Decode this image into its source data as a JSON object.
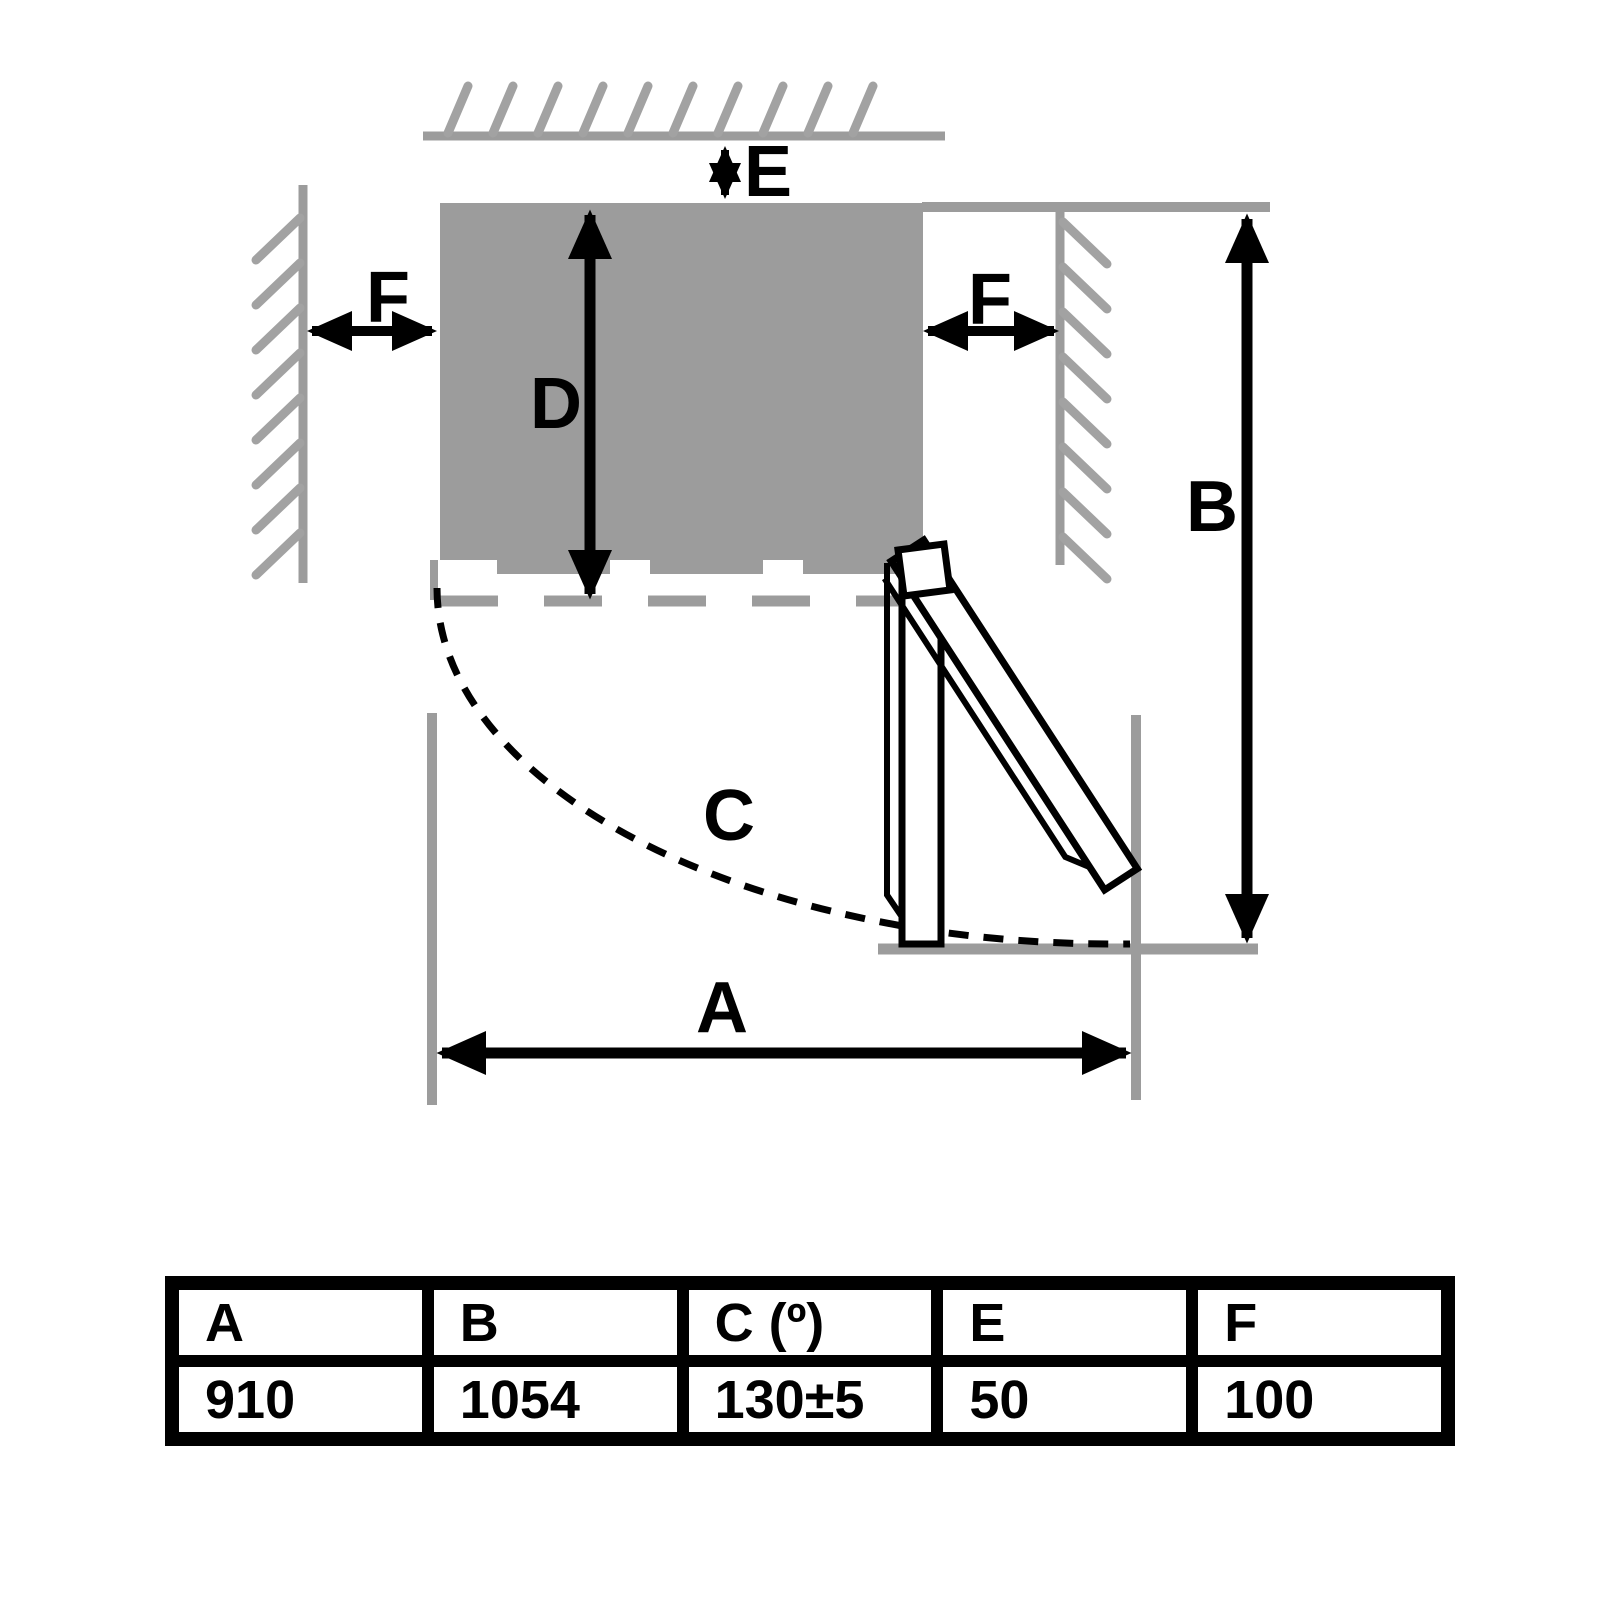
{
  "diagram": {
    "title": "appliance-installation-clearance-top-view",
    "labels": {
      "a": "A",
      "b": "B",
      "c": "C",
      "d": "D",
      "e": "E",
      "f_left": "F",
      "f_right": "F"
    }
  },
  "table": {
    "headers": [
      "A",
      "B",
      "C (º)",
      "E",
      "F"
    ],
    "values": [
      "910",
      "1054",
      "130±5",
      "50",
      "100"
    ]
  },
  "colors": {
    "structure_gray": "#9c9c9c",
    "hatch_gray": "#a2a2a2",
    "line_black": "#000000",
    "door_fill": "#ffffff",
    "background": "#ffffff"
  }
}
